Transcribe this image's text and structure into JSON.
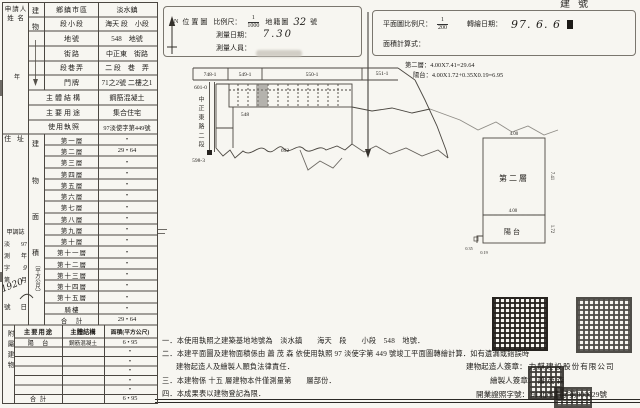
{
  "page": {
    "top_right_label": "建號"
  },
  "applicant": {
    "name_line1": "申請人",
    "name_line2": "姓 名",
    "mid_char": "年",
    "address_label": "住 址",
    "receipt": {
      "header": "甲調誌",
      "pairs": [
        [
          "淡",
          "97"
        ],
        [
          "測",
          "年"
        ],
        [
          "字",
          "9"
        ],
        [
          "第",
          "月"
        ]
      ],
      "hand_no": "1920",
      "tail_left": "號",
      "tail_right": "日"
    }
  },
  "building_col": {
    "top1": "建",
    "top2": "物",
    "area_chars": [
      "建",
      "物",
      "面",
      "積"
    ],
    "area_unit": "（平方公尺）"
  },
  "info_rows": [
    {
      "label": "鄉鎮市區",
      "value": "淡水鎮"
    },
    {
      "label": "段小段",
      "value": "海天 段　小段"
    },
    {
      "label": "地號",
      "value": "548　地號"
    },
    {
      "label": "街路",
      "value": "中正東　街路"
    },
    {
      "label": "段巷弄",
      "value": "二 段　巷　弄"
    },
    {
      "label": "門牌",
      "value": "71之2號 二樓之1"
    },
    {
      "label": "主體結構",
      "value": "鋼筋混凝土"
    },
    {
      "label": "主要用途",
      "value": "集合住宅"
    },
    {
      "label": "使用執照",
      "value": "97淡使字第449號"
    }
  ],
  "floors": [
    {
      "label": "第一層",
      "value": "•"
    },
    {
      "label": "第二層",
      "value": "29 • 64"
    },
    {
      "label": "第三層",
      "value": "•"
    },
    {
      "label": "第四層",
      "value": "•"
    },
    {
      "label": "第五層",
      "value": "•"
    },
    {
      "label": "第六層",
      "value": "•"
    },
    {
      "label": "第七層",
      "value": "•"
    },
    {
      "label": "第八層",
      "value": "•"
    },
    {
      "label": "第九層",
      "value": "•"
    },
    {
      "label": "第十層",
      "value": "•"
    },
    {
      "label": "第十一層",
      "value": "•"
    },
    {
      "label": "第十二層",
      "value": "•"
    },
    {
      "label": "第十三層",
      "value": "•"
    },
    {
      "label": "第十四層",
      "value": "•"
    },
    {
      "label": "第十五層",
      "value": "•"
    },
    {
      "label": "騎樓",
      "value": "•"
    },
    {
      "label": "合　計",
      "value": "29 • 64"
    }
  ],
  "annex": {
    "side_label": "附屬建物",
    "headers": [
      "主要用途",
      "主體結構",
      "面積(平方公尺)"
    ],
    "rows": [
      {
        "use": "陽　台",
        "structure": "鋼筋混凝土",
        "area": "6 • 95"
      },
      {
        "use": "",
        "structure": "",
        "area": "•"
      },
      {
        "use": "",
        "structure": "",
        "area": "•"
      },
      {
        "use": "",
        "structure": "",
        "area": "•"
      },
      {
        "use": "",
        "structure": "",
        "area": "•"
      },
      {
        "use": "",
        "structure": "",
        "area": "•"
      },
      {
        "use": "合 計",
        "structure": "",
        "area": "6 • 95"
      }
    ]
  },
  "location_box": {
    "north": "N",
    "title": "位置圖",
    "scale_label": "比例尺：",
    "scale_num": "1",
    "scale_den": "1000",
    "map_label": "地籍圖",
    "map_no": "32",
    "map_no_suffix": "號",
    "survey_date_label": "測量日期：",
    "survey_date": "7.30",
    "surveyor_label": "測量人員："
  },
  "plan_box": {
    "scale_label": "平面圖比例尺：",
    "scale_num": "1",
    "scale_den": "200",
    "redraw_label": "轉繪日期：",
    "redraw_date": "97. 6. 6",
    "formula_label": "面積計算式：",
    "formula_line1": "第二層：4.00X7.41=29.64",
    "formula_line2": "陽台：4.00X1.72+0.35X0.19=6.95"
  },
  "site_map": {
    "parcels": [
      "748-1",
      "549-1",
      "550-1",
      "551-1"
    ],
    "road_name": "中正東路二段",
    "corner_no": "601-0",
    "lower_no": "598-3",
    "site_no": "548",
    "south_no": "692"
  },
  "floor_plan": {
    "room_label": "第二層",
    "balcony_label": "陽台",
    "dim_width_top": "4.00",
    "dim_height_right": "7.41",
    "dim_width_mid": "4.00",
    "dim_balcony_right": "1.72",
    "dim_notch_w": "0.35",
    "dim_notch_h": "0.19"
  },
  "notes": {
    "line1": "一．本使用執照之建築基地地號為　淡水鎮　　海天　段　　小段　548　地號．",
    "line2": "二．本建平面圖及建物面積係由 蕭 茂 森 依使用執照 97 淡使字第 449 號竣工平面圖轉繪計算．如有遺漏或錯誤時",
    "line2b": "建物起造人及繪製人願負法律責任．",
    "line3": "三．本建物係 十五 層建物本件僅測量第　　層部份．",
    "line4": "四．本成果表以建物登記為限．"
  },
  "signatures": {
    "builder_label": "建物起造人簽章：",
    "builder_name": "力麒建設股份有限公司",
    "drafter_label": "繪製人簽章：",
    "drafter_name": "蕭茂森",
    "license_label": "開業證照字號：",
    "license_no": "91北市測字第000029號"
  }
}
